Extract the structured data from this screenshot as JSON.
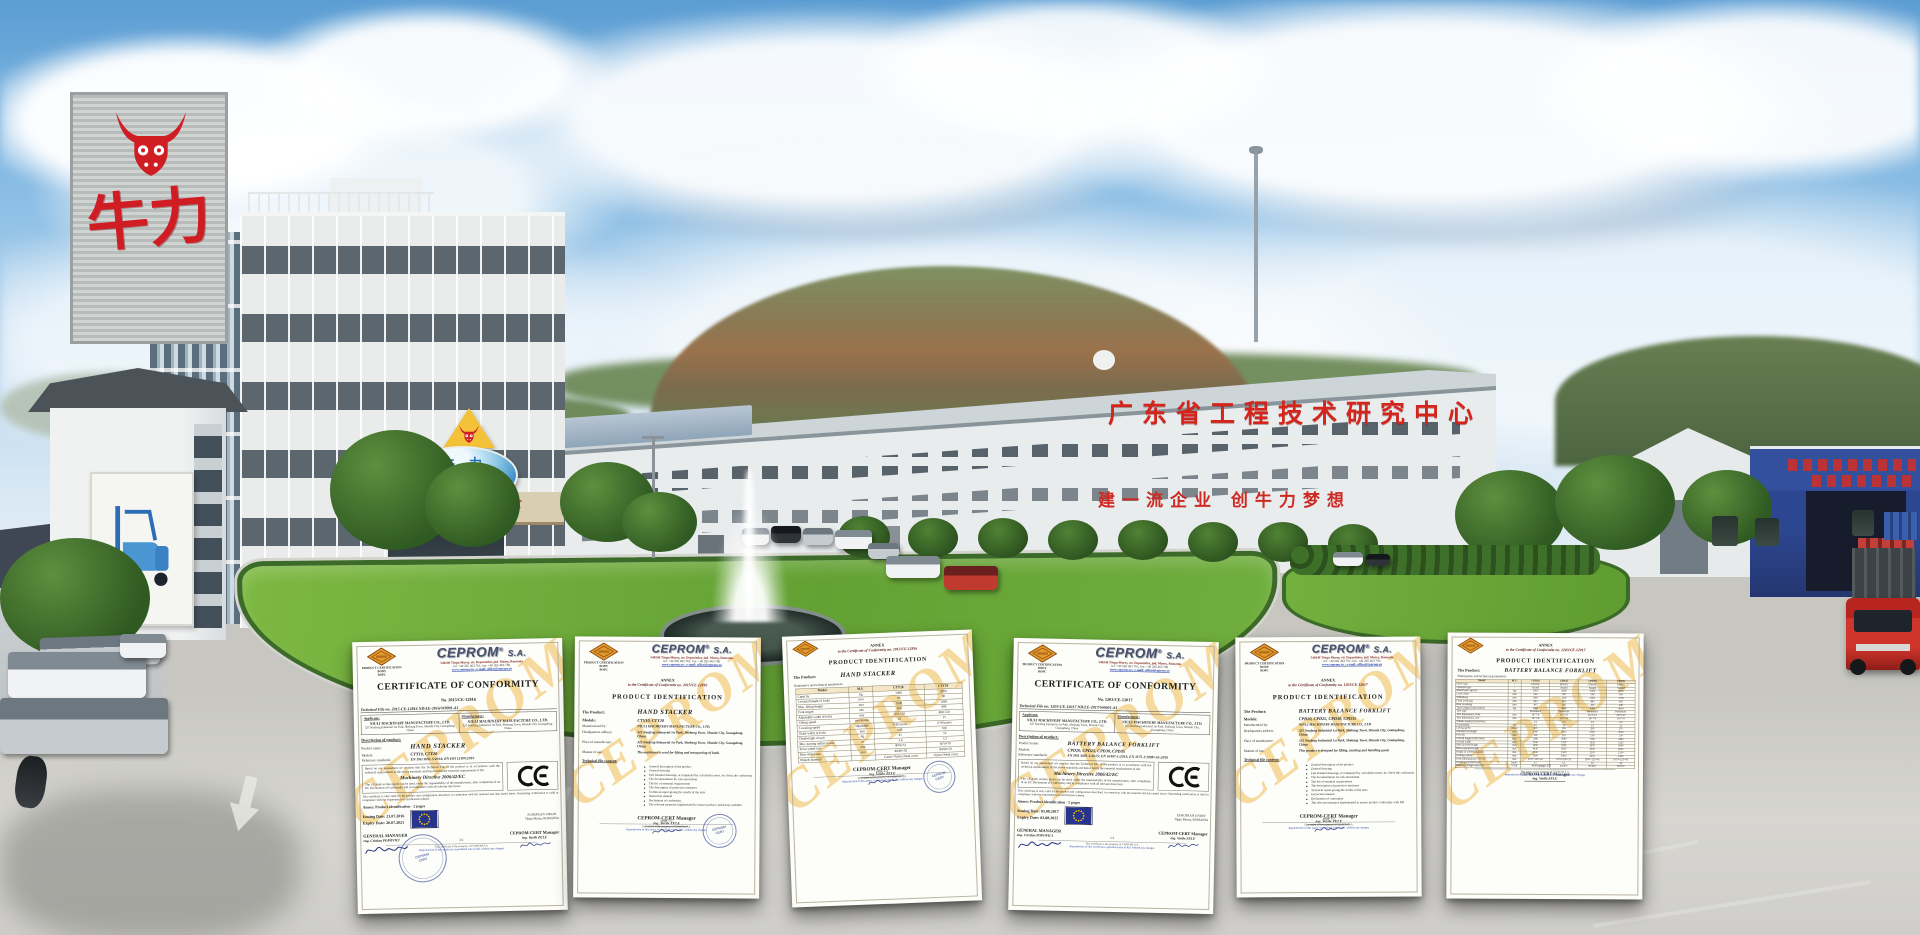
{
  "scene": {
    "signs": {
      "tower_brand": "牛力",
      "office_sign_cn": "牛力",
      "office_sign_en": "NIULI",
      "canopy_text": "牛遍天下",
      "rooftop_text": "广东省工程技术研究中心",
      "wall_slogan": "建一流企业  创牛力梦想"
    },
    "colors": {
      "brand_red": "#cf1d23",
      "sign_blue": "#2e74b8",
      "warehouse_blue": "#2c4a9b",
      "watermark_yell": "#eeb63f",
      "lawn_green": "#6fae3e",
      "sky_blue": "#6aa9dc",
      "road_grey": "#c9c8c3"
    }
  },
  "ceprom": {
    "body_line1": "PRODUCT CERTIFICATION BODY",
    "body_line2": "BOPC",
    "name": "CEPROM",
    "reg": "®",
    "suffix": "S.A.",
    "addr1": "540240 Târgu Mureş, str. Depozitelor, jud. Mureş, Romania",
    "addr2": "tel: +40 265 463 761; fax: +40 265 463 760",
    "addr3": "www.ceprom.ro ; e-mail: office@ceprom.ro",
    "stamp_line1": "CEPROM",
    "stamp_line2": "CERT",
    "watermark": "CEPROM"
  },
  "certs": [
    {
      "title": "CERTIFICATE OF CONFORMITY",
      "cert_no": "No. 2015/CE-12816",
      "tech_file": "Technical File no. 2015-CE-12816 ND/LE-2016/W0001-A1",
      "applicant_label": "Applicant:",
      "manufacturer_label": "Manufacturer:",
      "applicant_name": "NIULI MACHINARY MANUFACTURE CO., LTD.",
      "applicant_addr": "325 Nanfeng Industrial 1st Park, Shebang Town, Shunde City, Guangdong, China",
      "manufacturer_name": "NIULI MACHINERY MANUFACTURE CO., LTD.",
      "manufacturer_addr": "325 Nanfeng Industrial 1st Park, Shebang Town, Shunde City, Guangdong, China",
      "description_label": "Description of product:",
      "product_label": "Product name:",
      "product": "HAND STACKER",
      "models_label": "Models:",
      "models": "CTY10, CTY20",
      "standards_label": "Reference standards:",
      "standards": "EN ISO 3691-5:2014; EN ISO 12100:2010",
      "statement": "Based on our assessment we confirm that the Technical File of the product is in accordance with the technical requirements of the above standards and hence fulfils the essential requirements of the:",
      "directive": "Machinery Directive 2006/42/EC",
      "ce_statement": "The CE mark as here given can be used, under the responsibility of the manufacturer, after completion of an EC Declaration of Conformity and in compliance with all relevant directives.",
      "validity_statement": "This certificate is only valid for the product and configuration described, in connection with the material and data stated above. Remaining certification is valid in compliance with the requirements of certification scheme.",
      "annex_line": "Annex: Product identification - 2 pages",
      "issuing_label": "Issuing Date:",
      "issuing_date": "21.07.2016",
      "expiry_label": "Expiry Date:",
      "expiry_date": "20.07.2021",
      "eu_line1": "EUROPEAN UNION",
      "eu_line2": "Târgu Mureş, ROMANIA",
      "gm_label": "GENERAL MANAGER",
      "gm_name": "eng. Cristian POPOVICI",
      "mgr_label": "CEPROM-CERT Manager",
      "mgr_name": "ing. Vasile ZELE",
      "page": "1/1",
      "footer_line1": "This certificate is the property of CEPROM S.A.",
      "footer_line2": "Reproduction of this certificate is permitted only in full, without any changes"
    },
    {
      "annex_title": "ANNEX",
      "annex_sub": "to the Certificate of Conformity no. 2015/CE-12816",
      "title": "PRODUCT IDENTIFICATION",
      "product_label": "The Product:",
      "product": "HAND STACKER",
      "models_label": "Models:",
      "models": "CTY10, CTY20",
      "pairs": [
        [
          "Manufactured by:",
          "NIULI MACHINERY MANUFACTURE CO., LTD."
        ],
        [
          "Headquarters address:",
          "325 Nanfeng Industrial 1st Park, Shebang Town, Shunde City, Guangdong, China"
        ],
        [
          "Place of manufacture:",
          "325 Nanfeng Industrial 1st Park, Shebang Town, Shunde City, Guangdong, China"
        ],
        [
          "Manner of use:",
          "The machinery is used for lifting and transporting of loads"
        ]
      ],
      "tfc_label": "Technical file content:",
      "bullets": [
        "General description of the product",
        "General drawing",
        "Full detailed drawings, accompanied by calculation notes, for check the conformity",
        "The documentation for risk assessment",
        "The list of essential requirements",
        "The description of protective measures",
        "Technical report giving the results of the tests",
        "Instruction manual",
        "Declaration of conformity",
        "The relevant measures implemented to ensure product conformity with RD"
      ],
      "mgr_label": "CEPROM-CERT Manager",
      "mgr_name": "ing. Vasile ZELE",
      "page": "page 1/2",
      "footer_line1": "This annex is the property of CEPROM S.A.",
      "footer_line2": "Reproduction of this annex is permitted only in full, without any changes"
    },
    {
      "annex_title": "ANNEX",
      "annex_sub": "to the Certificate of Conformity no. 2015/CE-12816",
      "title": "PRODUCT IDENTIFICATION",
      "product_label": "The Product:",
      "product": "HAND STACKER",
      "table_caption": "Nominative and technical parameters:",
      "table_rows": [
        [
          "Model",
          "M.U.",
          "CTY10",
          "CTY20"
        ],
        [
          "Capacity",
          "kg",
          "1000",
          "2000"
        ],
        [
          "Lowered height of forks",
          "mm",
          "90",
          "90"
        ],
        [
          "Max. lifting height",
          "mm",
          "1600",
          "1600"
        ],
        [
          "Fork length",
          "mm",
          "900",
          "900"
        ],
        [
          "Adjustable width of forks",
          "mm",
          "350-550",
          "400-720"
        ],
        [
          "Lifting speed",
          "mm/stroke",
          "25",
          "15"
        ],
        [
          "Lowering speed",
          "adjustable",
          "0-90 mm/s",
          "0-90 mm/s"
        ],
        [
          "Outer width of forks",
          "mm",
          "685",
          "695"
        ],
        [
          "Deadweight of unit",
          "kg",
          "45",
          "52"
        ],
        [
          "Min. turning radius of unit",
          "m",
          "1.4",
          "1.5"
        ],
        [
          "Front wheel size",
          "mm",
          "Φ74×72",
          "Φ74×70"
        ],
        [
          "Rear wheel size",
          "mm",
          "Φ180×50",
          "Φ180×50"
        ],
        [
          "Wheels material",
          "-",
          "Castor Nylon (Steel core)",
          "Nylon (Steel core)"
        ]
      ],
      "mgr_label": "CEPROM-CERT Manager",
      "mgr_name": "ing. Vasile ZELE",
      "page": "page 2/2",
      "footer_line1": "This annex is the property of CEPROM S.A.",
      "footer_line2": "Reproduction of this annex is permitted only in full, without any changes"
    },
    {
      "title": "CERTIFICATE OF CONFORMITY",
      "cert_no": "No. 1203/CE-12017",
      "tech_file": "Technical File no. 1203-CE-12017 ND/LE-2017/W0001-A1",
      "applicant_label": "Applicant:",
      "manufacturer_label": "Manufacturer:",
      "applicant_name": "NIULI MACHINERY MANUFACTURE CO., LTD.",
      "applicant_addr": "325 Nanfeng Industrial 1st Park, Shebang Town, Shunde City, Guangdong, China",
      "manufacturer_name": "NIULI MACHINERY MANUFACTURE CO., LTD.",
      "manufacturer_addr": "325 Nanfeng Industrial 1st Park, Shebang Town, Shunde City, Guangdong, China",
      "description_label": "Description of product:",
      "product_label": "Product name:",
      "product": "BATTERY BALANCE FORKLIFT",
      "models_label": "Models:",
      "models": "CPD20, CPD25, CPD30, CPD35",
      "standards_label": "Reference standards:",
      "standards": "EN ISO 3691-1:2015; EN 16307-1:2013; EN 1175-1:1998+A1:2010",
      "statement": "Based on our assessment we confirm that the Technical File of the product is in accordance with the technical requirements of the above standards and hence fulfils the essential requirements of the:",
      "directive": "Machinery Directive 2006/42/EC",
      "ce_statement": "The CE mark as here given can be used, under the responsibility of the manufacturer, after completion of an EC Declaration of Conformity and in compliance with all relevant directives.",
      "validity_statement": "This certificate is only valid for the product and configuration described, in connection with the material and data stated above. Remaining certification is valid in compliance with the requirements of certification scheme.",
      "annex_line": "Annex: Product identification - 2 pages",
      "issuing_label": "Issuing Date:",
      "issuing_date": "03.08.2017",
      "expiry_label": "Expiry Date:",
      "expiry_date": "02.08.2022",
      "eu_line1": "EUROPEAN UNION",
      "eu_line2": "Târgu Mureş, ROMANIA",
      "gm_label": "GENERAL MANAGER",
      "gm_name": "eng. Cristian POPOVICI",
      "mgr_label": "CEPROM-CERT Manager",
      "mgr_name": "ing. Vasile ZELE",
      "page": "1/1",
      "footer_line1": "This certificate is the property of CEPROM S.A.",
      "footer_line2": "Reproduction of this certificate is permitted only in full, without any changes"
    },
    {
      "annex_title": "ANNEX",
      "annex_sub": "to the Certificate of Conformity no. 1203/CE-12017",
      "title": "PRODUCT IDENTIFICATION",
      "product_label": "The Product:",
      "product": "BATTERY BALANCE FORKLIFT",
      "models_label": "Models:",
      "models": "CPD20, CPD25, CPD30, CPD35",
      "pairs": [
        [
          "Manufactured by:",
          "NIULI MACHINERY MANUFACTURE CO., LTD."
        ],
        [
          "Headquarters address:",
          "325 Nanfeng Industrial 1st Park, Shebang Town, Shunde City, Guangdong, China"
        ],
        [
          "Place of manufacture:",
          "325 Nanfeng Industrial 1st Park, Shebang Town, Shunde City, Guangdong, China"
        ],
        [
          "Manner of use:",
          "This product is designed for lifting, stacking and handling goods"
        ]
      ],
      "tfc_label": "Technical file content:",
      "bullets": [
        "General description of the product",
        "General drawing",
        "Full detailed drawings, accompanied by calculation notes, for check the conformity",
        "The documentation for risk assessment",
        "The list of essential requirements",
        "The description of protective measures",
        "Technical report giving the results of the tests",
        "Instruction manual",
        "Declaration of conformity",
        "The relevant measures implemented to ensure product conformity with RD"
      ],
      "mgr_label": "CEPROM-CERT Manager",
      "mgr_name": "ing. Vasile ZELE",
      "page": "page 1/2",
      "footer_line1": "This annex is the property of CEPROM S.A.",
      "footer_line2": "Reproduction of this annex is permitted only in full, without any changes"
    },
    {
      "annex_title": "ANNEX",
      "annex_sub": "to the Certificate of Conformity no. 1203/CE-12017",
      "title": "PRODUCT IDENTIFICATION",
      "product_label": "The Product:",
      "product": "BATTERY BALANCE FORKLIFT",
      "table_caption": "Nominative and technical parameters:",
      "table_rows": [
        [
          "Model",
          "M.U.",
          "CPD20",
          "CPD25",
          "CPD30",
          "CPD35"
        ],
        [
          "Drive type",
          "-",
          "Electric",
          "Electric",
          "Electric",
          "Electric"
        ],
        [
          "Operator type",
          "-",
          "Seated",
          "Seated",
          "Seated",
          "Seated"
        ],
        [
          "Rated load capacity",
          "kg",
          "2000",
          "2500",
          "3000",
          "3500"
        ],
        [
          "Load center",
          "mm",
          "500",
          "500",
          "500",
          "500"
        ],
        [
          "Wheelbase",
          "mm",
          "1400",
          "1400",
          "1600",
          "1700"
        ],
        [
          "Front overhang",
          "mm",
          "465",
          "465",
          "480",
          "495"
        ],
        [
          "Rear overhang",
          "mm",
          "405",
          "405",
          "425",
          "440"
        ],
        [
          "Total weight (with battery)",
          "kg",
          "3460",
          "3860",
          "4380",
          "4800"
        ],
        [
          "Tyre type",
          "-",
          "Pneumatic",
          "Pneumatic",
          "Pneumatic",
          "Pneumatic"
        ],
        [
          "Tyre dimensions, front",
          "mm",
          "18×7-8",
          "18×7-8",
          "28×9-15",
          "28×9-15"
        ],
        [
          "Tyre dimensions, rear",
          "mm",
          "18×7-8",
          "18×7-8",
          "18×7-8",
          "18×7-8"
        ],
        [
          "Wheels number (front/rear)",
          "-",
          "2/2",
          "2/2",
          "2/2",
          "2/2"
        ],
        [
          "Gradeability",
          "%",
          "15",
          "15",
          "15",
          "15"
        ],
        [
          "Lifting speed",
          "mm/s",
          "300",
          "300",
          "280",
          "270"
        ],
        [
          "Standard lift height",
          "mm",
          "3000",
          "3000",
          "3000",
          "3000"
        ],
        [
          "Free lift",
          "mm",
          "110",
          "110",
          "130",
          "130"
        ],
        [
          "Overall length (with forks)",
          "mm",
          "3080",
          "3080",
          "3380",
          "3480"
        ],
        [
          "Overall width",
          "mm",
          "1150",
          "1150",
          "1225",
          "1225"
        ],
        [
          "Mast lowered height",
          "mm",
          "1995",
          "1995",
          "2070",
          "2080"
        ],
        [
          "Mast extended height",
          "mm",
          "4030",
          "4030",
          "4050",
          "4060"
        ],
        [
          "Height of overhead guard",
          "mm",
          "2100",
          "2100",
          "2110",
          "2130"
        ],
        [
          "Turning radius",
          "mm",
          "1900",
          "1900",
          "2230",
          "2340"
        ],
        [
          "Fork dimensions (L×W×T)",
          "mm",
          "1070×100×35",
          "1070×100×35",
          "1070×125×45",
          "1070×125×45"
        ],
        [
          "Travel speed (full load)",
          "km/h",
          "13",
          "13",
          "14",
          "14"
        ],
        [
          "Battery (voltage/capacity)",
          "V/Ah",
          "48/400",
          "48/400",
          "80/400",
          "80/500"
        ]
      ],
      "mgr_label": "CEPROM-CERT Manager",
      "mgr_name": "ing. Vasile ZELE",
      "page": "page 2/2",
      "footer_line1": "This annex is the property of CEPROM S.A.",
      "footer_line2": "Reproduction of this annex is permitted only in full, without any changes"
    }
  ]
}
